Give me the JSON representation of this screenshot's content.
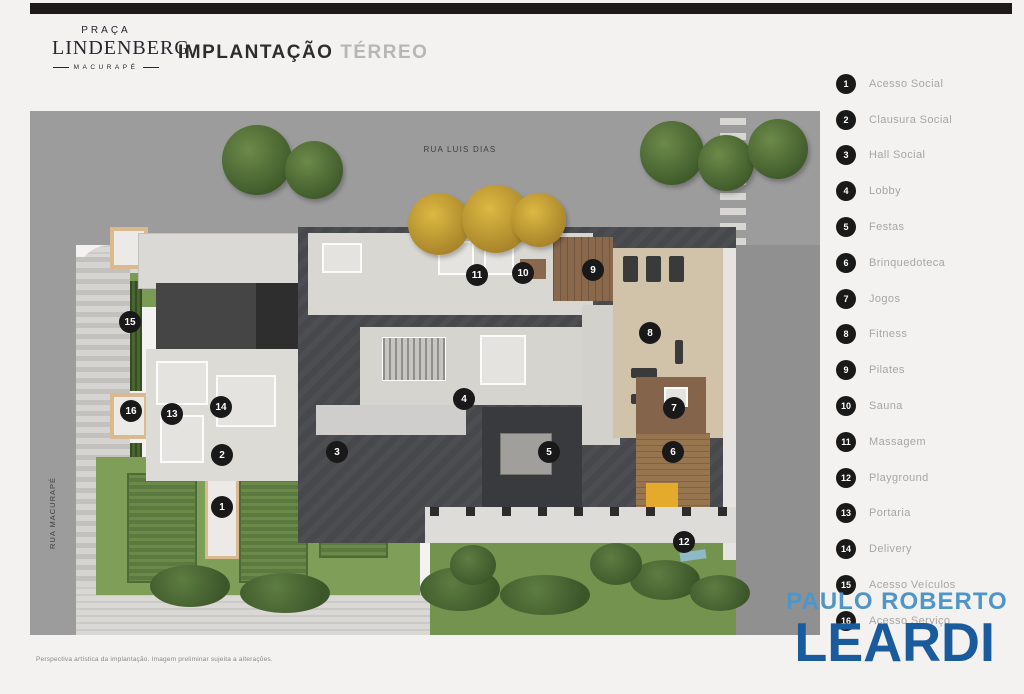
{
  "header": {
    "logo": {
      "line1": "PRAÇA",
      "line2": "LINDENBERG",
      "line3": "MACURAPÉ"
    },
    "title_bold": "IMPLANTAÇÃO",
    "title_light": "TÉRREO"
  },
  "plan": {
    "street_top_label": "RUA LUIS DIAS",
    "street_left_label": "RUA MACURAPÉ",
    "markers": [
      {
        "n": "1",
        "x": 192,
        "y": 402
      },
      {
        "n": "2",
        "x": 192,
        "y": 350
      },
      {
        "n": "3",
        "x": 307,
        "y": 347
      },
      {
        "n": "4",
        "x": 434,
        "y": 294
      },
      {
        "n": "5",
        "x": 519,
        "y": 347
      },
      {
        "n": "6",
        "x": 643,
        "y": 347
      },
      {
        "n": "7",
        "x": 644,
        "y": 303
      },
      {
        "n": "8",
        "x": 620,
        "y": 228
      },
      {
        "n": "9",
        "x": 563,
        "y": 165
      },
      {
        "n": "10",
        "x": 493,
        "y": 168
      },
      {
        "n": "11",
        "x": 447,
        "y": 170
      },
      {
        "n": "12",
        "x": 654,
        "y": 437
      },
      {
        "n": "13",
        "x": 142,
        "y": 309
      },
      {
        "n": "14",
        "x": 191,
        "y": 302
      },
      {
        "n": "15",
        "x": 100,
        "y": 217
      },
      {
        "n": "16",
        "x": 101,
        "y": 306
      }
    ]
  },
  "legend": {
    "items": [
      {
        "n": "1",
        "label": "Acesso Social"
      },
      {
        "n": "2",
        "label": "Clausura Social"
      },
      {
        "n": "3",
        "label": "Hall Social"
      },
      {
        "n": "4",
        "label": "Lobby"
      },
      {
        "n": "5",
        "label": "Festas"
      },
      {
        "n": "6",
        "label": "Brinquedoteca"
      },
      {
        "n": "7",
        "label": "Jogos"
      },
      {
        "n": "8",
        "label": "Fitness"
      },
      {
        "n": "9",
        "label": "Pilates"
      },
      {
        "n": "10",
        "label": "Sauna"
      },
      {
        "n": "11",
        "label": "Massagem"
      },
      {
        "n": "12",
        "label": "Playground"
      },
      {
        "n": "13",
        "label": "Portaria"
      },
      {
        "n": "14",
        "label": "Delivery"
      },
      {
        "n": "15",
        "label": "Acesso Veículos"
      },
      {
        "n": "16",
        "label": "Acesso Serviço"
      }
    ]
  },
  "watermark": {
    "line1": "PAULO ROBERTO",
    "line2": "LEARDI"
  },
  "footer": {
    "disclaimer": "Perspectiva artística da implantação. Imagem preliminar sujeita a alterações."
  },
  "colors": {
    "watermark_light": "#4e96c8",
    "watermark_dark": "#1a5b9e",
    "marker_bg": "#191919",
    "title_dark": "#2e2d2b",
    "title_light": "#b8b6b4",
    "street_gray": "#9c9c9c"
  }
}
